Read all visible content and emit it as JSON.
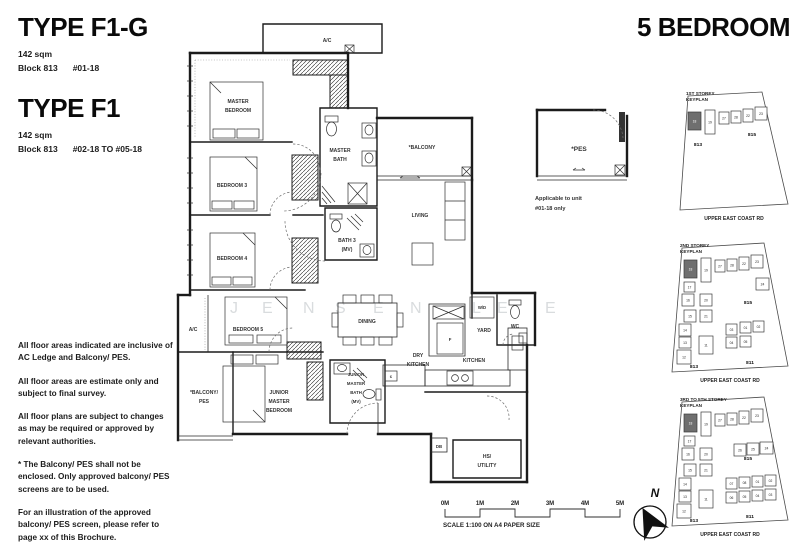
{
  "header": {
    "type1": {
      "title": "TYPE F1-G",
      "area": "142 sqm",
      "block": "Block 813",
      "units": "#01-18"
    },
    "type2": {
      "title": "TYPE F1",
      "area": "142 sqm",
      "block": "Block 813",
      "units": "#02-18 TO #05-18"
    },
    "bedroom_title": "5 BEDROOM"
  },
  "notes": [
    "All floor areas indicated are inclusive of AC Ledge and Balcony/ PES.",
    "All floor areas are estimate only and subject to final survey.",
    "All floor plans are subject to changes as may be required or approved by relevant authorities.",
    "* The Balcony/ PES shall not be enclosed. Only approved balcony/ PES screens are to be used.",
    "For an illustration of the approved balcony/ PES screen, please refer to page xx of this Brochure."
  ],
  "plan": {
    "ac_top": "A/C",
    "master_bedroom": [
      "MASTER",
      "BEDROOM"
    ],
    "master_bath": [
      "MASTER",
      "BATH"
    ],
    "balcony": "*BALCONY",
    "living": "LIVING",
    "bedroom3": "BEDROOM 3",
    "bedroom4": "BEDROOM 4",
    "bath3": [
      "BATH 3",
      "(MV)"
    ],
    "bedroom5": "BEDROOM 5",
    "ac_left": "A/C",
    "balcony_pes": [
      "*BALCONY/",
      "PES"
    ],
    "junior_master_bedroom": [
      "JUNIOR",
      "MASTER",
      "BEDROOM"
    ],
    "junior_master_bath": [
      "JUNIOR",
      "MASTER",
      "BATH",
      "(MV)"
    ],
    "dining": "DINING",
    "dry_kitchen": [
      "DRY",
      "KITCHEN"
    ],
    "kitchen": "KITCHEN",
    "fridge": "F",
    "cooker": "c",
    "yard": "YARD",
    "wd": "W/D",
    "wc": "WC",
    "db": "DB",
    "hs_utility": [
      "HS/",
      "UTILITY"
    ],
    "pes": "*PES",
    "pes_note": [
      "Applicable to unit",
      "#01-18 only"
    ]
  },
  "keyplans": [
    {
      "title": [
        "1ST STOREY",
        "KEYPLAN"
      ],
      "road": "UPPER EAST COAST RD",
      "blocks": [
        {
          "t": "813",
          "x": 30,
          "y": 58
        },
        {
          "t": "815",
          "x": 84,
          "y": 48
        }
      ],
      "units": [
        {
          "n": "18",
          "x": 20,
          "y": 24,
          "w": 13,
          "h": 18,
          "dark": true
        },
        {
          "n": "19",
          "x": 37,
          "y": 22,
          "w": 10,
          "h": 24
        },
        {
          "n": "27",
          "x": 51,
          "y": 24,
          "w": 10,
          "h": 12
        },
        {
          "n": "28",
          "x": 63,
          "y": 23,
          "w": 10,
          "h": 12
        },
        {
          "n": "22",
          "x": 75,
          "y": 21,
          "w": 10,
          "h": 13
        },
        {
          "n": "23",
          "x": 87,
          "y": 19,
          "w": 12,
          "h": 13
        }
      ]
    },
    {
      "title": [
        "2ND STOREY",
        "KEYPLAN"
      ],
      "road": "UPPER EAST COAST RD",
      "blocks": [
        {
          "t": "813",
          "x": 30,
          "y": 128
        },
        {
          "t": "815",
          "x": 84,
          "y": 64
        },
        {
          "t": "811",
          "x": 86,
          "y": 124
        }
      ],
      "units": [
        {
          "n": "18",
          "x": 20,
          "y": 20,
          "w": 13,
          "h": 18,
          "dark": true
        },
        {
          "n": "19",
          "x": 37,
          "y": 18,
          "w": 10,
          "h": 24
        },
        {
          "n": "27",
          "x": 51,
          "y": 20,
          "w": 10,
          "h": 12
        },
        {
          "n": "28",
          "x": 63,
          "y": 19,
          "w": 10,
          "h": 12
        },
        {
          "n": "22",
          "x": 75,
          "y": 17,
          "w": 10,
          "h": 13
        },
        {
          "n": "23",
          "x": 87,
          "y": 15,
          "w": 12,
          "h": 13
        },
        {
          "n": "24",
          "x": 92,
          "y": 38,
          "w": 13,
          "h": 12
        },
        {
          "n": "17",
          "x": 20,
          "y": 42,
          "w": 11,
          "h": 10
        },
        {
          "n": "16",
          "x": 18,
          "y": 54,
          "w": 12,
          "h": 12
        },
        {
          "n": "20",
          "x": 36,
          "y": 54,
          "w": 12,
          "h": 12
        },
        {
          "n": "15",
          "x": 20,
          "y": 70,
          "w": 12,
          "h": 12
        },
        {
          "n": "21",
          "x": 36,
          "y": 70,
          "w": 12,
          "h": 12
        },
        {
          "n": "14",
          "x": 15,
          "y": 84,
          "w": 12,
          "h": 12
        },
        {
          "n": "13",
          "x": 15,
          "y": 97,
          "w": 12,
          "h": 11
        },
        {
          "n": "12",
          "x": 13,
          "y": 110,
          "w": 14,
          "h": 14
        },
        {
          "n": "11",
          "x": 35,
          "y": 96,
          "w": 14,
          "h": 18
        },
        {
          "n": "03",
          "x": 62,
          "y": 84,
          "w": 11,
          "h": 11
        },
        {
          "n": "01",
          "x": 76,
          "y": 82,
          "w": 11,
          "h": 11
        },
        {
          "n": "02",
          "x": 89,
          "y": 81,
          "w": 11,
          "h": 11
        },
        {
          "n": "04",
          "x": 62,
          "y": 97,
          "w": 11,
          "h": 11
        },
        {
          "n": "05",
          "x": 76,
          "y": 96,
          "w": 11,
          "h": 11
        }
      ]
    },
    {
      "title": [
        "3RD TO 5TH STOREY",
        "KEYPLAN"
      ],
      "road": "UPPER EAST COAST RD",
      "blocks": [
        {
          "t": "813",
          "x": 30,
          "y": 128
        },
        {
          "t": "815",
          "x": 84,
          "y": 66
        },
        {
          "t": "811",
          "x": 86,
          "y": 124
        }
      ],
      "units": [
        {
          "n": "18",
          "x": 20,
          "y": 20,
          "w": 13,
          "h": 18,
          "dark": true
        },
        {
          "n": "19",
          "x": 37,
          "y": 18,
          "w": 10,
          "h": 24
        },
        {
          "n": "27",
          "x": 51,
          "y": 20,
          "w": 10,
          "h": 12
        },
        {
          "n": "28",
          "x": 63,
          "y": 19,
          "w": 10,
          "h": 12
        },
        {
          "n": "22",
          "x": 75,
          "y": 17,
          "w": 10,
          "h": 13
        },
        {
          "n": "23",
          "x": 87,
          "y": 15,
          "w": 12,
          "h": 13
        },
        {
          "n": "26",
          "x": 70,
          "y": 50,
          "w": 12,
          "h": 12
        },
        {
          "n": "25",
          "x": 83,
          "y": 49,
          "w": 12,
          "h": 12
        },
        {
          "n": "24",
          "x": 96,
          "y": 48,
          "w": 13,
          "h": 12
        },
        {
          "n": "17",
          "x": 20,
          "y": 42,
          "w": 11,
          "h": 10
        },
        {
          "n": "16",
          "x": 18,
          "y": 54,
          "w": 12,
          "h": 12
        },
        {
          "n": "20",
          "x": 36,
          "y": 54,
          "w": 12,
          "h": 12
        },
        {
          "n": "15",
          "x": 20,
          "y": 70,
          "w": 12,
          "h": 12
        },
        {
          "n": "21",
          "x": 36,
          "y": 70,
          "w": 12,
          "h": 12
        },
        {
          "n": "14",
          "x": 15,
          "y": 84,
          "w": 12,
          "h": 12
        },
        {
          "n": "13",
          "x": 15,
          "y": 97,
          "w": 12,
          "h": 11
        },
        {
          "n": "12",
          "x": 13,
          "y": 110,
          "w": 14,
          "h": 14
        },
        {
          "n": "11",
          "x": 35,
          "y": 96,
          "w": 14,
          "h": 18
        },
        {
          "n": "07",
          "x": 62,
          "y": 84,
          "w": 11,
          "h": 11
        },
        {
          "n": "08",
          "x": 75,
          "y": 83,
          "w": 11,
          "h": 11
        },
        {
          "n": "01",
          "x": 88,
          "y": 82,
          "w": 11,
          "h": 11
        },
        {
          "n": "02",
          "x": 101,
          "y": 81,
          "w": 11,
          "h": 11
        },
        {
          "n": "06",
          "x": 62,
          "y": 98,
          "w": 11,
          "h": 11
        },
        {
          "n": "05",
          "x": 75,
          "y": 97,
          "w": 11,
          "h": 11
        },
        {
          "n": "04",
          "x": 88,
          "y": 96,
          "w": 11,
          "h": 11
        },
        {
          "n": "03",
          "x": 101,
          "y": 95,
          "w": 11,
          "h": 11
        }
      ]
    }
  ],
  "scalebar": {
    "ticks": [
      "0M",
      "1M",
      "2M",
      "3M",
      "4M",
      "5M"
    ],
    "caption": "SCALE 1:100 ON A4 PAPER SIZE"
  },
  "compass": {
    "north": "N"
  },
  "watermark": {
    "y": 300,
    "letters": [
      {
        "ch": "J",
        "x": 230
      },
      {
        "ch": "E",
        "x": 262
      },
      {
        "ch": "N",
        "x": 303
      },
      {
        "ch": "S",
        "x": 335
      },
      {
        "ch": "E",
        "x": 373
      },
      {
        "ch": "N",
        "x": 410
      },
      {
        "ch": "L",
        "x": 472
      },
      {
        "ch": "E",
        "x": 497
      },
      {
        "ch": "E",
        "x": 545
      }
    ]
  }
}
